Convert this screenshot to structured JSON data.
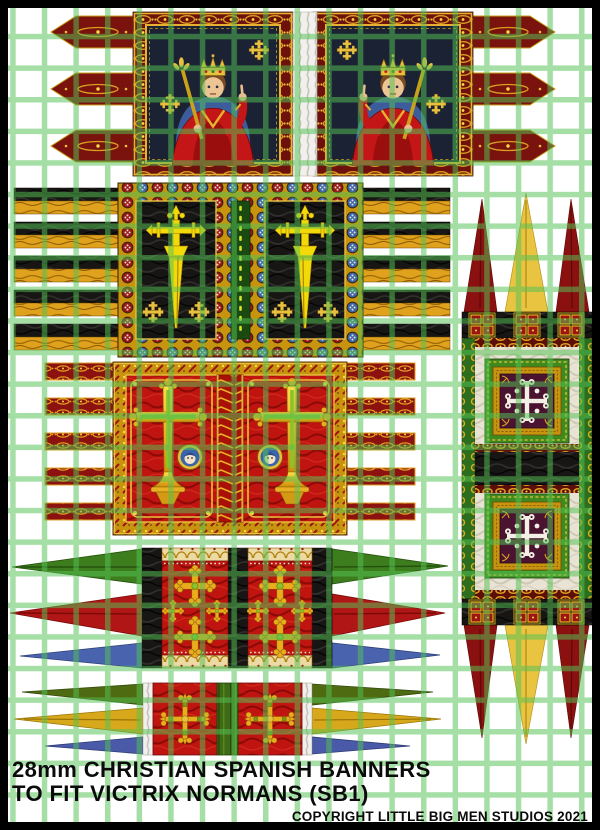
{
  "footer": {
    "title_line1": "28mm CHRISTIAN SPANISH BANNERS",
    "title_line2": "TO FIT VICTRIX NORMANS (SB1)",
    "copyright": "COPYRIGHT LITTLE BIG MEN STUDIOS 2021"
  },
  "sheet": {
    "kind": "printed wargames banner sheet",
    "paper_color": "#ffffff",
    "grid_color": "#54c254",
    "frame_color": "#000000",
    "banners": [
      {
        "name": "twin-kings-banner",
        "position": "top-row",
        "description": "Two mirrored panels of a crowned king with sceptre on dark blue field, red and gold knotwork border, white fringed fold in centre, three red pointed tails each side",
        "colors": [
          "#6e100b",
          "#d8a020",
          "#1b2233",
          "#c41616"
        ]
      },
      {
        "name": "santiago-sword-cross-banner",
        "position": "second-row",
        "description": "Black fields bearing the yellow sword-cross of Santiago with small cross-crosslets, border of red and blue rosettes on gold, five black-and-gold striped tails each side",
        "colors": [
          "#171614",
          "#f2d908",
          "#9c1414",
          "#3a64aa"
        ]
      },
      {
        "name": "red-cross-banner",
        "position": "third-row",
        "description": "Red fields with tall gold and green cross and saint roundel, ornate gold border, five red-and-gold ribbon tails each side",
        "colors": [
          "#c01410",
          "#e8b020",
          "#8cc22c",
          "#3a64aa"
        ]
      },
      {
        "name": "triple-streamer-banner-large",
        "position": "fourth-row",
        "description": "Red panels with gold bottony crosses between black bands, gold arcade edging, long green red and blue streamers each side",
        "colors": [
          "#3e7d1e",
          "#b01616",
          "#4a63ae",
          "#171614"
        ]
      },
      {
        "name": "triple-streamer-banner-small",
        "position": "fifth-row",
        "description": "Red panels with gold fleury cross flanking a green centre band, dark-green yellow and blue streamers each side",
        "colors": [
          "#4e6b12",
          "#d8a81c",
          "#4a5aa8",
          "#c01410"
        ]
      },
      {
        "name": "calatrava-standard",
        "position": "right-column",
        "description": "Vertical standard: silver field with two crimson squares bearing a white cross flory, green and gold borders, black bands with gold square clusters, red and yellow pointed tails top and bottom",
        "colors": [
          "#8a1110",
          "#e8c441",
          "#4a1430",
          "#2d6e1e",
          "#e8e3d4"
        ]
      }
    ]
  }
}
